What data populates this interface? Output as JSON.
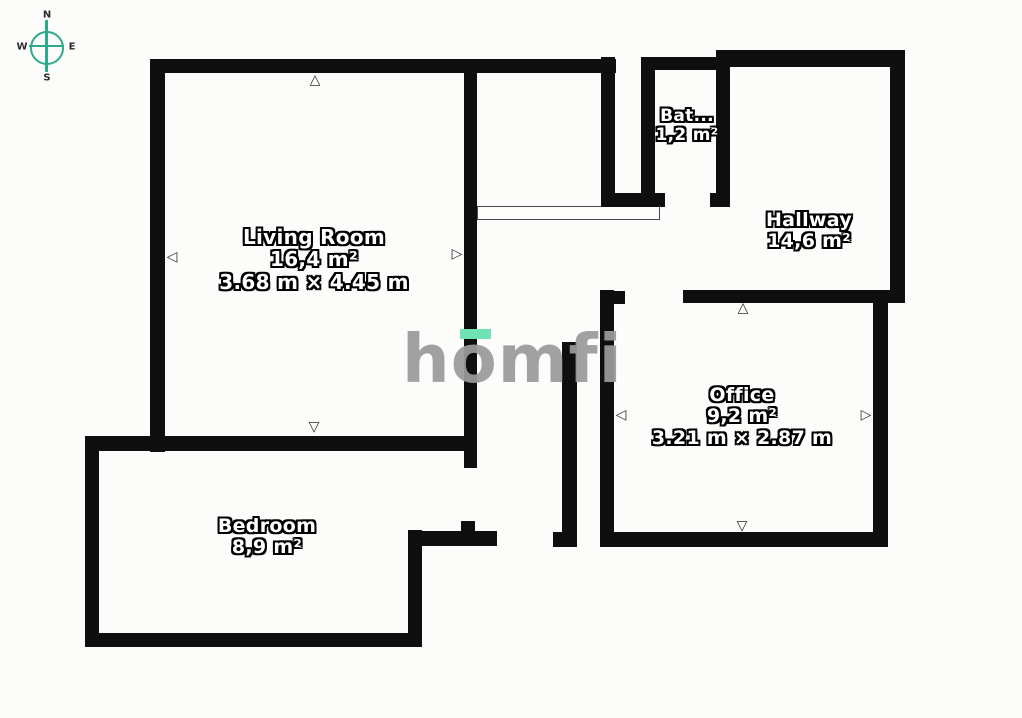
{
  "compass": {
    "north": "N",
    "south": "S",
    "west": "W",
    "east": "E"
  },
  "logo": {
    "text": "homfi",
    "accent_color": "#6fe3b4",
    "text_color": "#9b9b9b"
  },
  "rooms": {
    "living_room": {
      "name": "Living Room",
      "area": "16,4 m²",
      "dimensions": "3.68 m × 4.45 m"
    },
    "bathroom": {
      "name": "Bat...",
      "area": "1,2 m²"
    },
    "hallway": {
      "name": "Hallway",
      "area": "14,6 m²"
    },
    "office": {
      "name": "Office",
      "area": "9,2 m²",
      "dimensions": "3.21 m × 2.87 m"
    },
    "bedroom": {
      "name": "Bedroom",
      "area": "8,9 m²"
    }
  },
  "markers": {
    "up": "△",
    "down": "▽",
    "left": "◁",
    "right": "▷"
  },
  "colors": {
    "wall": "#0f0f0f",
    "background": "#fcfcfa",
    "compass_green": "#2fa98c"
  }
}
